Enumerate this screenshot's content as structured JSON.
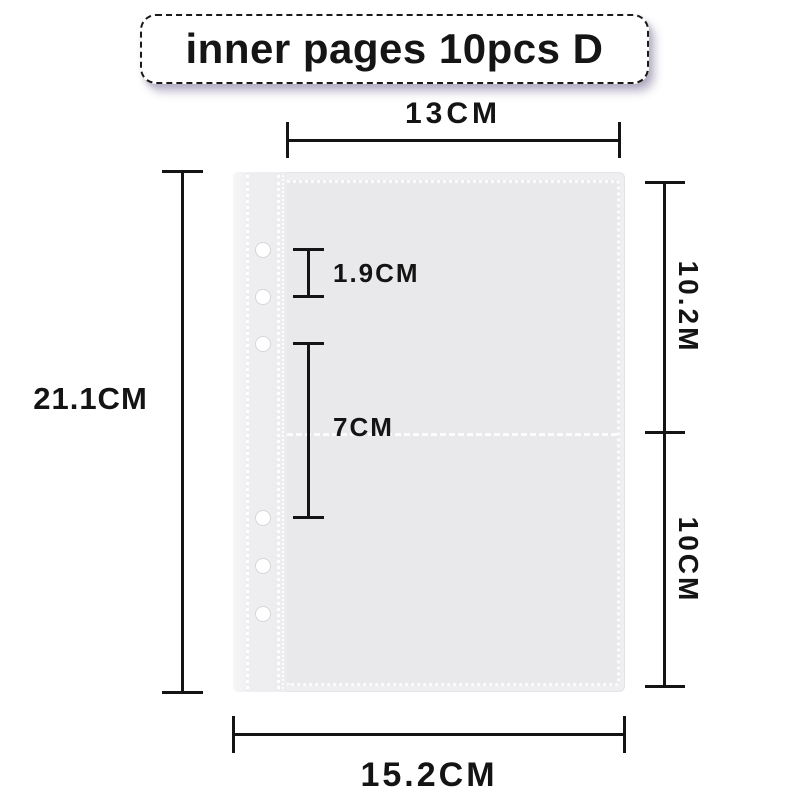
{
  "title_banner": {
    "text": "inner pages 10pcs D"
  },
  "diagram": {
    "subject": "binder inner page sleeve with ring holes and two pockets",
    "hole_count": 6
  },
  "dimension_labels": {
    "pocket_width_top": "13CM",
    "page_height_left": "21.1CM",
    "hole_spacing": "1.9CM",
    "hole_group_gap": "7CM",
    "upper_pocket_height_right": "10.2M",
    "lower_pocket_height_right": "10CM",
    "page_width_bottom": "15.2CM"
  },
  "colors": {
    "page_background": "#ffffff",
    "sleeve_fill": "#efeff1",
    "pocket_fill": "#e9e9eb",
    "stitch_white": "#fbfbfd",
    "dimension_line": "#141414",
    "banner_border": "#1a1a1a",
    "banner_shadow": "rgba(124,112,150,0.45)"
  }
}
